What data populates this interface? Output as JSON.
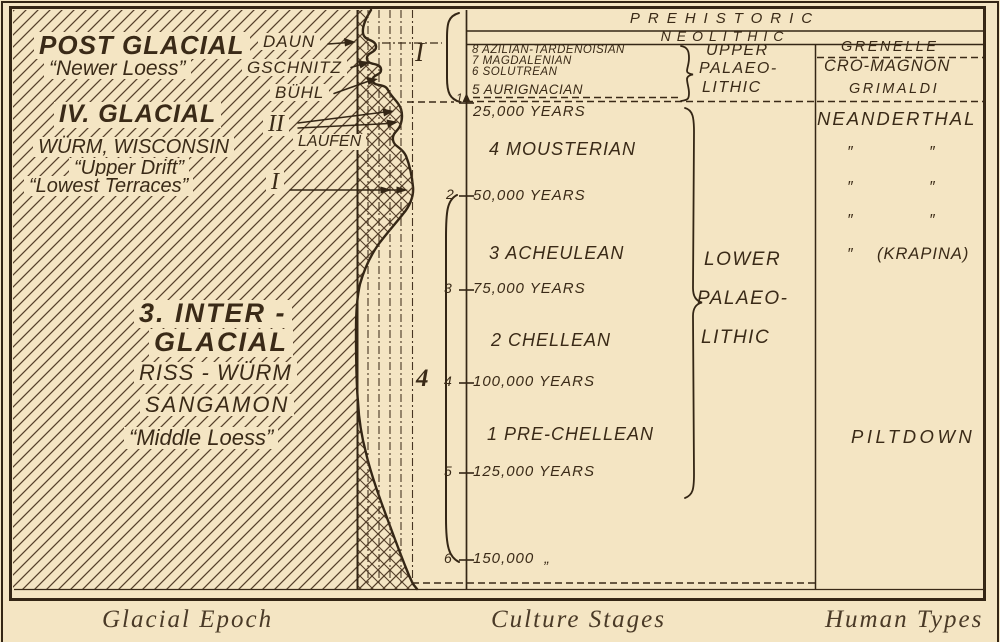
{
  "colors": {
    "paper": "#f4e5c3",
    "ink": "#3a2a17",
    "caption_ink": "#4a3a27"
  },
  "left_panel": {
    "post_glacial_title": "POST GLACIAL",
    "post_glacial_sub": "“Newer Loess”",
    "stage_daun": "DAUN",
    "stage_gschnitz": "GSCHNITZ",
    "stage_buhl": "BÜHL",
    "stage_laufen": "LAUFEN",
    "numeral_ii": "II",
    "numeral_i": "I",
    "glacial4_title": "IV. GLACIAL",
    "glacial4_names": "WÜRM, WISCONSIN",
    "glacial4_drift": "“Upper Drift”",
    "glacial4_terraces": "“Lowest Terraces”",
    "inter_line1": "3. INTER -",
    "inter_line2": "GLACIAL",
    "inter_line3": "RISS - WÜRM",
    "inter_line4": "SANGAMON",
    "inter_line5": "“Middle Loess”",
    "caption": "Glacial Epoch"
  },
  "timeline": {
    "numeral_upper": "I",
    "numeral_lower": "4",
    "ticks": [
      "1",
      "2",
      "3",
      "4",
      "5",
      "6"
    ]
  },
  "culture": {
    "band_prehistoric": "PREHISTORIC",
    "band_neolithic": "NEOLITHIC",
    "upper_stages": [
      "8 AZILIAN-TARDENOISIAN",
      "7 MAGDALENIAN",
      "6 SOLUTREAN",
      "5 AURIGNACIAN"
    ],
    "upper_group": [
      "UPPER",
      "PALAEO-",
      "LITHIC"
    ],
    "years": [
      "25,000 YEARS",
      "50,000 YEARS",
      "75,000 YEARS",
      "100,000 YEARS",
      "125,000 YEARS",
      "150,000  „"
    ],
    "stages": [
      "4 MOUSTERIAN",
      "3 ACHEULEAN",
      "2 CHELLEAN",
      "1 PRE-CHELLEAN"
    ],
    "lower_group": [
      "LOWER",
      "PALAEO-",
      "LITHIC"
    ],
    "caption": "Culture Stages"
  },
  "human": {
    "grenelle": "GRENELLE",
    "cro_magnon": "CRO-MAGNON",
    "grimaldi": "GRIMALDI",
    "neanderthal": "NEANDERTHAL",
    "ditto": "″",
    "krapina": "(KRAPINA)",
    "piltdown": "PILTDOWN",
    "caption": "Human Types"
  }
}
